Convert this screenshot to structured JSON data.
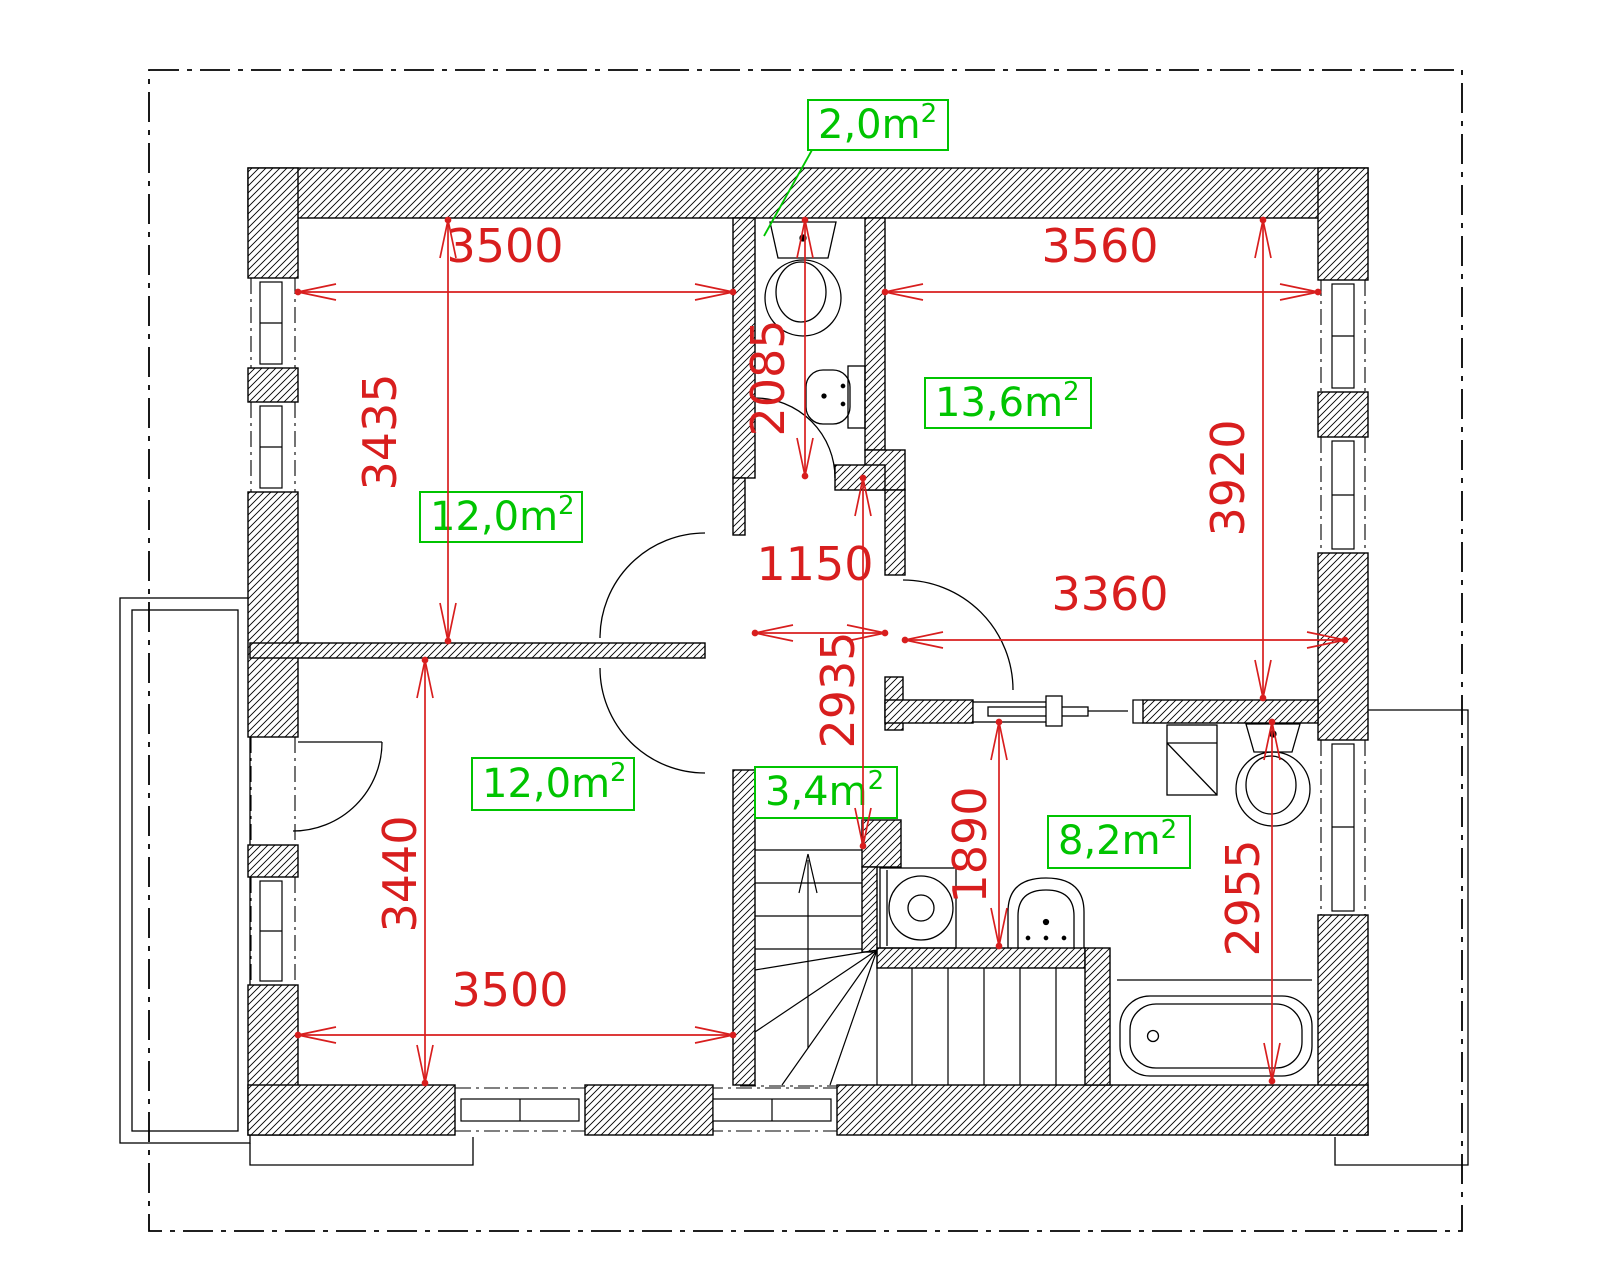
{
  "plan": {
    "type": "floor-plan",
    "colors": {
      "dimension_red": "#d81e1e",
      "area_green": "#00c400",
      "line_black": "#000000"
    },
    "area_labels": [
      {
        "id": "wc",
        "value": "2,0m",
        "sup": "2"
      },
      {
        "id": "bedroom_top_left",
        "value": "12,0m",
        "sup": "2"
      },
      {
        "id": "room_top_right",
        "value": "13,6m",
        "sup": "2"
      },
      {
        "id": "bedroom_bottom_left",
        "value": "12,0m",
        "sup": "2"
      },
      {
        "id": "stair_landing",
        "value": "3,4m",
        "sup": "2"
      },
      {
        "id": "bathroom",
        "value": "8,2m",
        "sup": "2"
      }
    ],
    "dimensions_mm": [
      {
        "id": "top_left_room_width",
        "value": "3500"
      },
      {
        "id": "top_left_room_depth",
        "value": "3435"
      },
      {
        "id": "top_right_room_width",
        "value": "3560"
      },
      {
        "id": "top_right_room_depth",
        "value": "3920"
      },
      {
        "id": "wc_depth",
        "value": "2085"
      },
      {
        "id": "hall_width",
        "value": "1150"
      },
      {
        "id": "hall_depth",
        "value": "2935"
      },
      {
        "id": "bathroom_width",
        "value": "3360"
      },
      {
        "id": "bottom_left_room_depth",
        "value": "3440"
      },
      {
        "id": "bottom_left_room_width",
        "value": "3500"
      },
      {
        "id": "bath_zone_depth",
        "value": "1890"
      },
      {
        "id": "bathroom_depth",
        "value": "2955"
      }
    ],
    "fixtures": [
      "toilet",
      "wash-basin",
      "toilet",
      "wash-basin",
      "washing-machine",
      "bathtub",
      "shower-cabinet",
      "stairs",
      "bathtub-alcove"
    ]
  }
}
